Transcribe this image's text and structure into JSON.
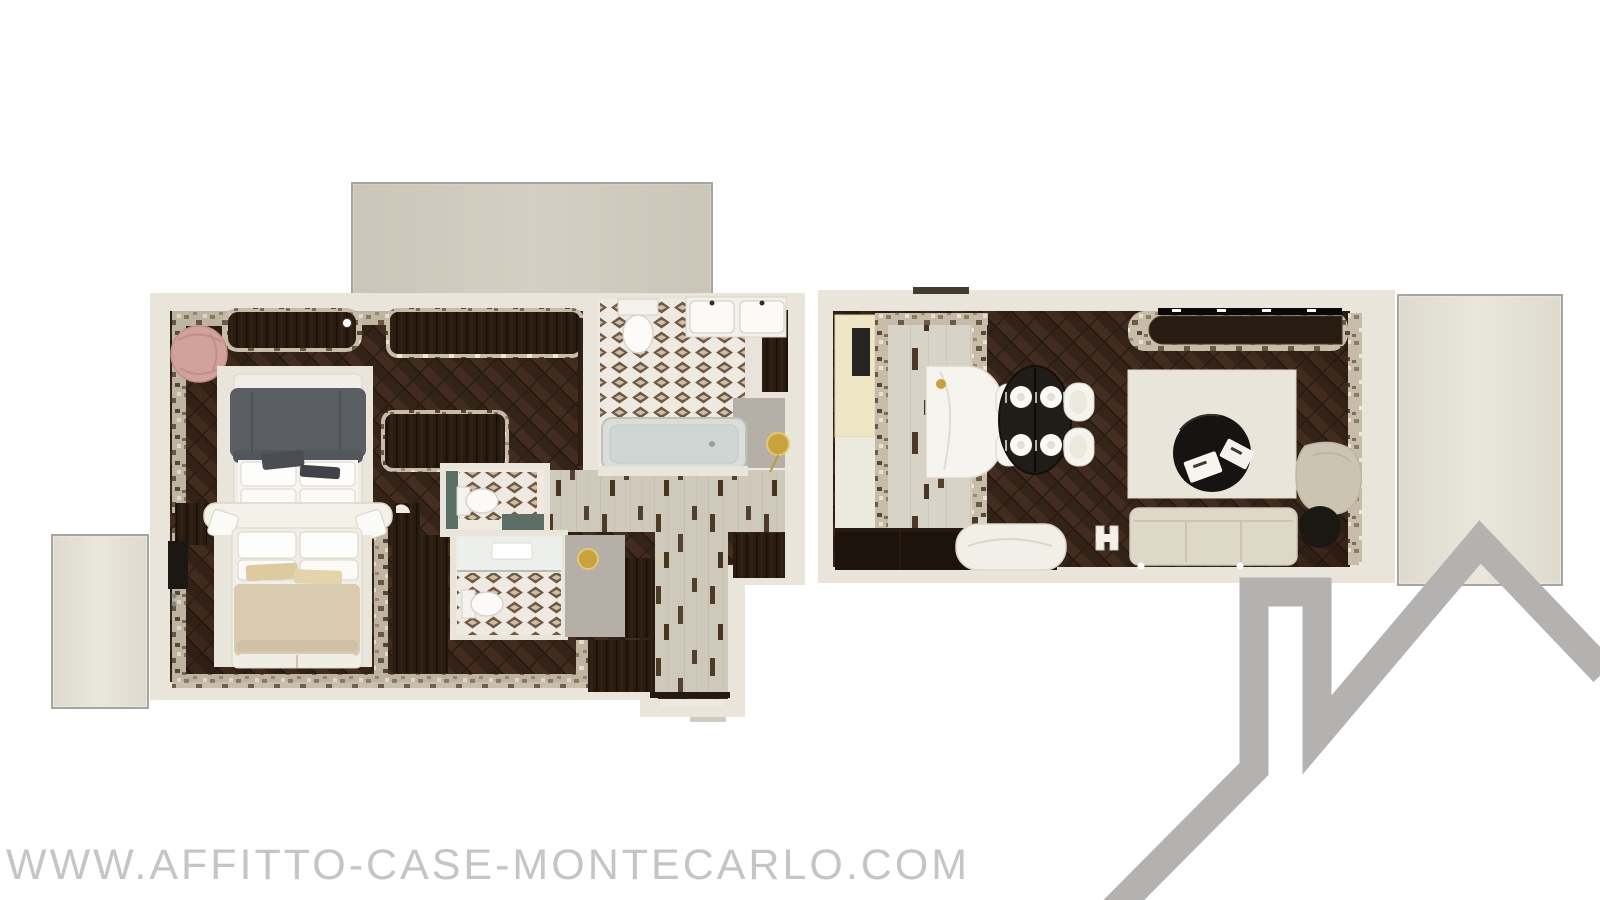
{
  "page": {
    "type": "real-estate-floorplan-image",
    "background_color": "#ffffff",
    "width_px": 1600,
    "height_px": 900
  },
  "watermark": {
    "text": "WWW.AFFITTO-CASE-MONTECARLO.COM",
    "color": "#c7c5c3"
  },
  "logo": {
    "shape": "house-roofline-with-chimney",
    "color": "#b4b2b1"
  },
  "palette": {
    "wall": "#eae5da",
    "wood_floor": "#3a281d",
    "terrace_top": "#d3cfc2",
    "terrace_side": "#e9e6db",
    "terrace_border": "#a6a69f",
    "bath_base": "#efe9e0",
    "gray_floor": "#b5afa7",
    "rug": "#e9e5da",
    "sofa": "#ded8c9",
    "armchair": "#ccc4b2",
    "duvet_gray": "#5b5f64",
    "duvet_beige": "#d8cbb0",
    "chair_pink": "#d3a19b",
    "gold": "#c9a23e",
    "black_furniture": "#1b1713",
    "table_black": "#201c18",
    "teal_accent": "#5c6f66",
    "door_panel_yellow": "#efe6c6",
    "door_panel_ivory": "#eceadf",
    "white_furniture": "#f4f1ea",
    "tub": "#d9dedb",
    "shower": "#edefec",
    "headboard_white": "#f4f1ea"
  },
  "floorplan": {
    "description": "Top-down 3D rendered floor plan of an apartment with two wings, three terraces, two bedrooms, three bathrooms, kitchen-dining area and living room",
    "terraces": [
      "top-terrace",
      "right-terrace",
      "left-terrace"
    ],
    "left_wing": {
      "rooms": [
        "bedroom-1",
        "bedroom-2",
        "main-bathroom",
        "wc-1",
        "wc-2",
        "hallway",
        "wardrobe-corridor"
      ],
      "furniture": [
        "double-bed-gray",
        "double-bed-beige",
        "pink-round-armchair",
        "shared-headboard",
        "nightstands",
        "tv-panel",
        "wardrobes",
        "bathtub",
        "double-sink-vanity",
        "toilets",
        "shower",
        "gold-ceiling-lamps"
      ]
    },
    "right_wing": {
      "rooms": [
        "entry",
        "kitchen",
        "dining-area",
        "living-room"
      ],
      "furniture": [
        "kitchen-island",
        "oval-dining-table",
        "four-plates",
        "four-dining-chairs",
        "sideboard",
        "white-chaise",
        "area-rug",
        "round-coffee-table",
        "sofa",
        "lounge-armchair",
        "round-side-table",
        "tv-console"
      ]
    }
  }
}
